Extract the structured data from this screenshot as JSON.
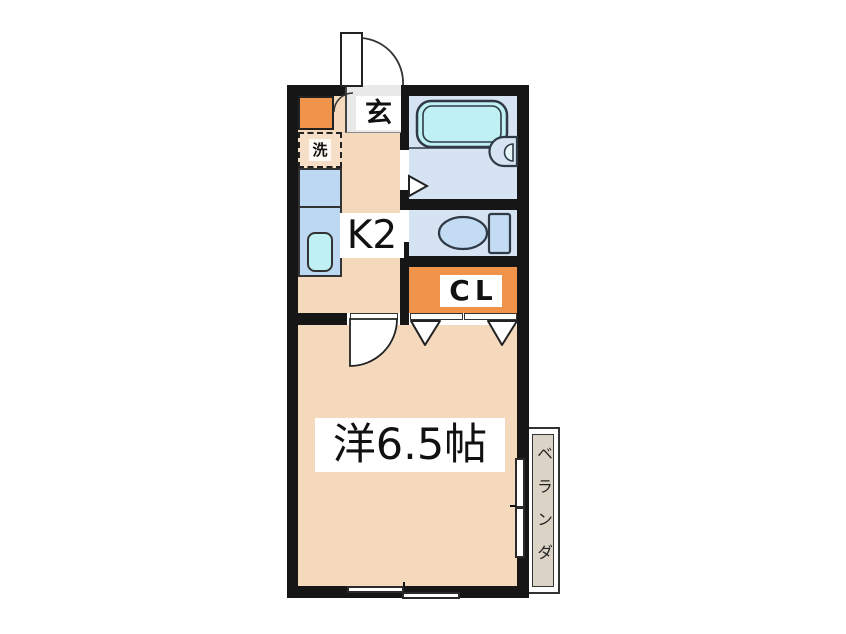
{
  "plan": {
    "type": "apartment-floor-plan",
    "labels": {
      "entrance": "玄",
      "laundry": "洗",
      "kitchen": "K2",
      "closet": "CL",
      "main_room": "洋6.5帖",
      "balcony": "ベランダ"
    },
    "colors": {
      "wall": "#161616",
      "floor": "#F4D9BC",
      "accent_orange": "#F0944C",
      "counter_blue": "#BDD8F2",
      "fixture_cyan": "#BFF0F4",
      "wet_floor_blue": "#D6E3F2",
      "toilet_fixture_blue": "#C3DCF4",
      "genkan_gray": "#E9E9E9",
      "balcony_tan": "#DBD3C5",
      "outline_dark": "#2F3A46"
    }
  }
}
